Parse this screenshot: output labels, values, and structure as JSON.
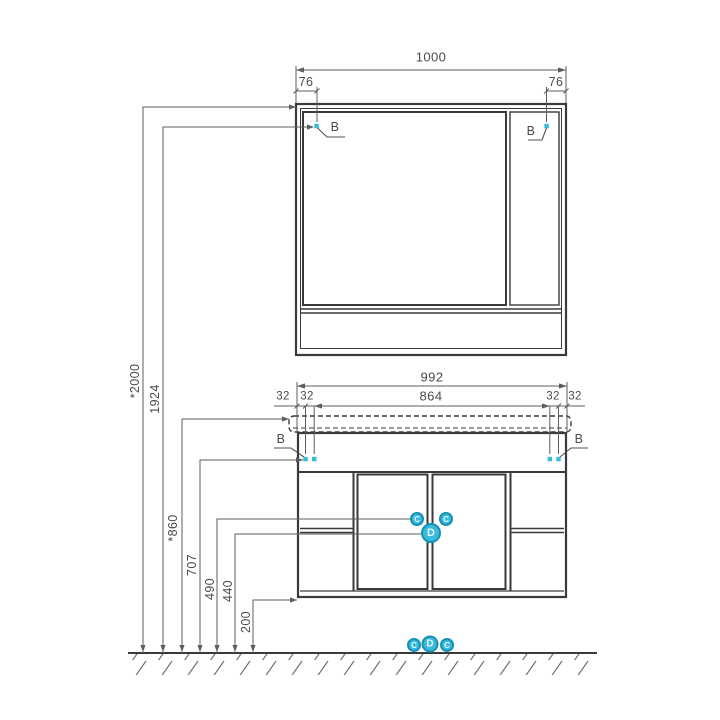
{
  "colors": {
    "accent_cyan": "#3cbadd",
    "accent_cyan_dark": "#1691b6",
    "furniture_line": "#3a3a3a",
    "dimension_line": "#5d5d5d",
    "label_text": "#4a4a4a"
  },
  "mirror_cabinet": {
    "width": "1000",
    "offset_left": "76",
    "offset_right": "76",
    "callout_left": "B",
    "callout_right": "B"
  },
  "vanity": {
    "width": "992",
    "mount_width": "864",
    "offsets": [
      "32",
      "32",
      "32",
      "32"
    ],
    "callout_left": "B",
    "callout_right": "B"
  },
  "door_markers": {
    "small_left": "C",
    "small_right": "C",
    "main": "D"
  },
  "floor_markers": {
    "left": "C",
    "center": "D",
    "right": "C"
  },
  "heights": {
    "total": "*2000",
    "mirror_mount": "1924",
    "countertop": "*860",
    "vanity_mount": "707",
    "upper": "490",
    "lower": "440",
    "floor_gap": "200"
  }
}
